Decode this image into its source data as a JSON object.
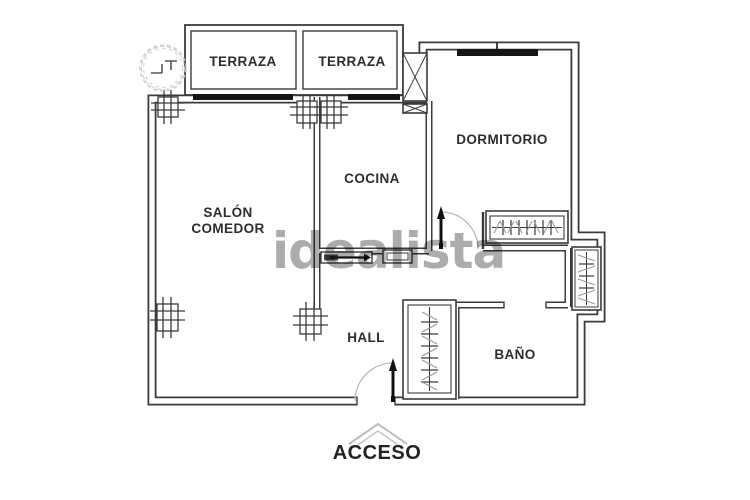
{
  "watermark": {
    "text": "idealista"
  },
  "rooms": {
    "terraza_1": {
      "label": "TERRAZA"
    },
    "terraza_2": {
      "label": "TERRAZA"
    },
    "dormitorio": {
      "label": "DORMITORIO"
    },
    "cocina": {
      "label": "COCINA"
    },
    "salon": {
      "label_line1": "SALÓN",
      "label_line2": "COMEDOR"
    },
    "hall": {
      "label": "HALL"
    },
    "bano": {
      "label": "BAÑO"
    }
  },
  "entrance": {
    "label": "ACCESO"
  },
  "icons": {
    "tree": "tree-icon",
    "shaft": "shaft-x-icon",
    "wardrobes": "wardrobe-hanger-icon",
    "doors": "door-swing-icon",
    "sliding_door": "sliding-door-icon",
    "entrance_marker": "entrance-chevron-icon",
    "columns": "structural-column-icon"
  },
  "colors": {
    "wall": "#3b3b3b",
    "window_bar": "#161616",
    "watermark": "#9e9e9e",
    "hatch_gray": "#9a9a9a",
    "swing_arc": "#b8b8b8",
    "background": "#ffffff"
  }
}
